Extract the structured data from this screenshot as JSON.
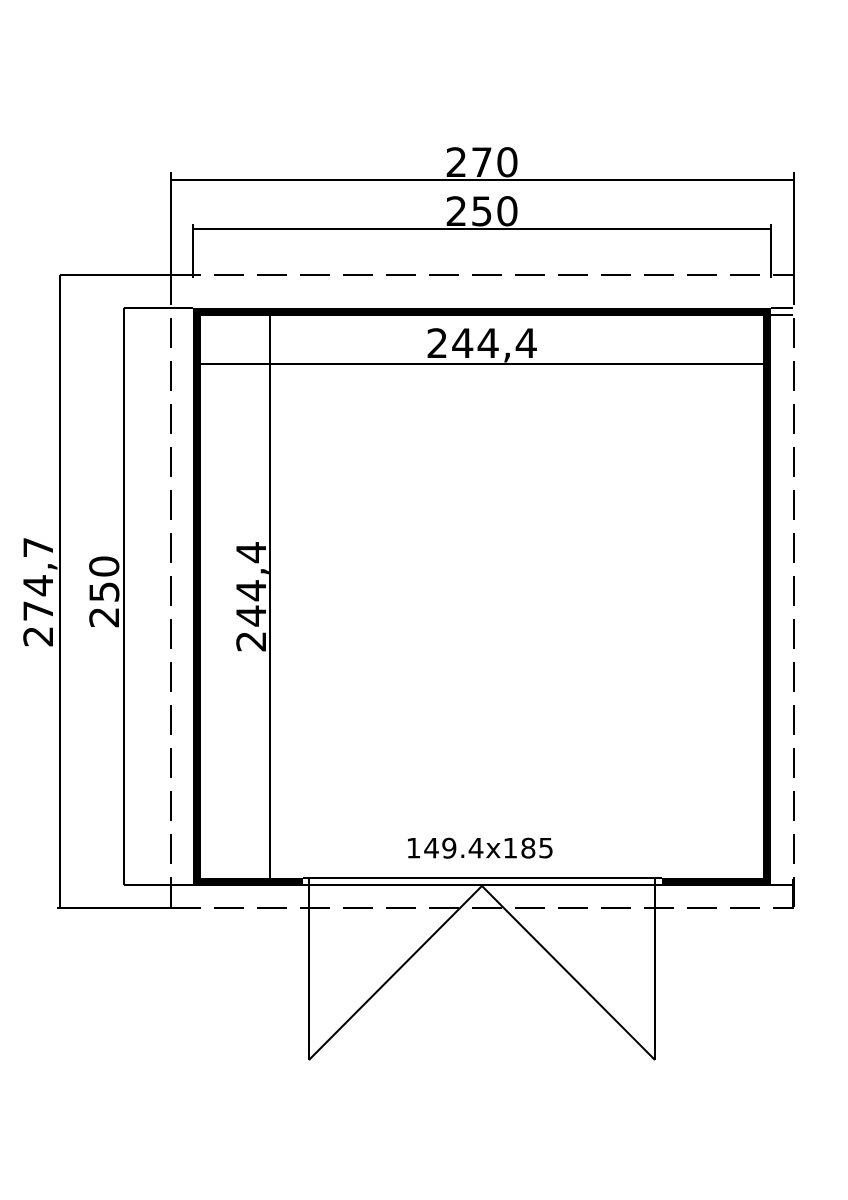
{
  "drawing": {
    "type": "floor-plan",
    "labels": {
      "overall_width": "270",
      "wall_outer_width": "250",
      "interior_width": "244,4",
      "overall_depth": "274,7",
      "wall_outer_depth": "250",
      "interior_depth": "244,4",
      "door_size": "149.4x185"
    },
    "colors": {
      "line": "#000000",
      "background": "#ffffff"
    }
  }
}
